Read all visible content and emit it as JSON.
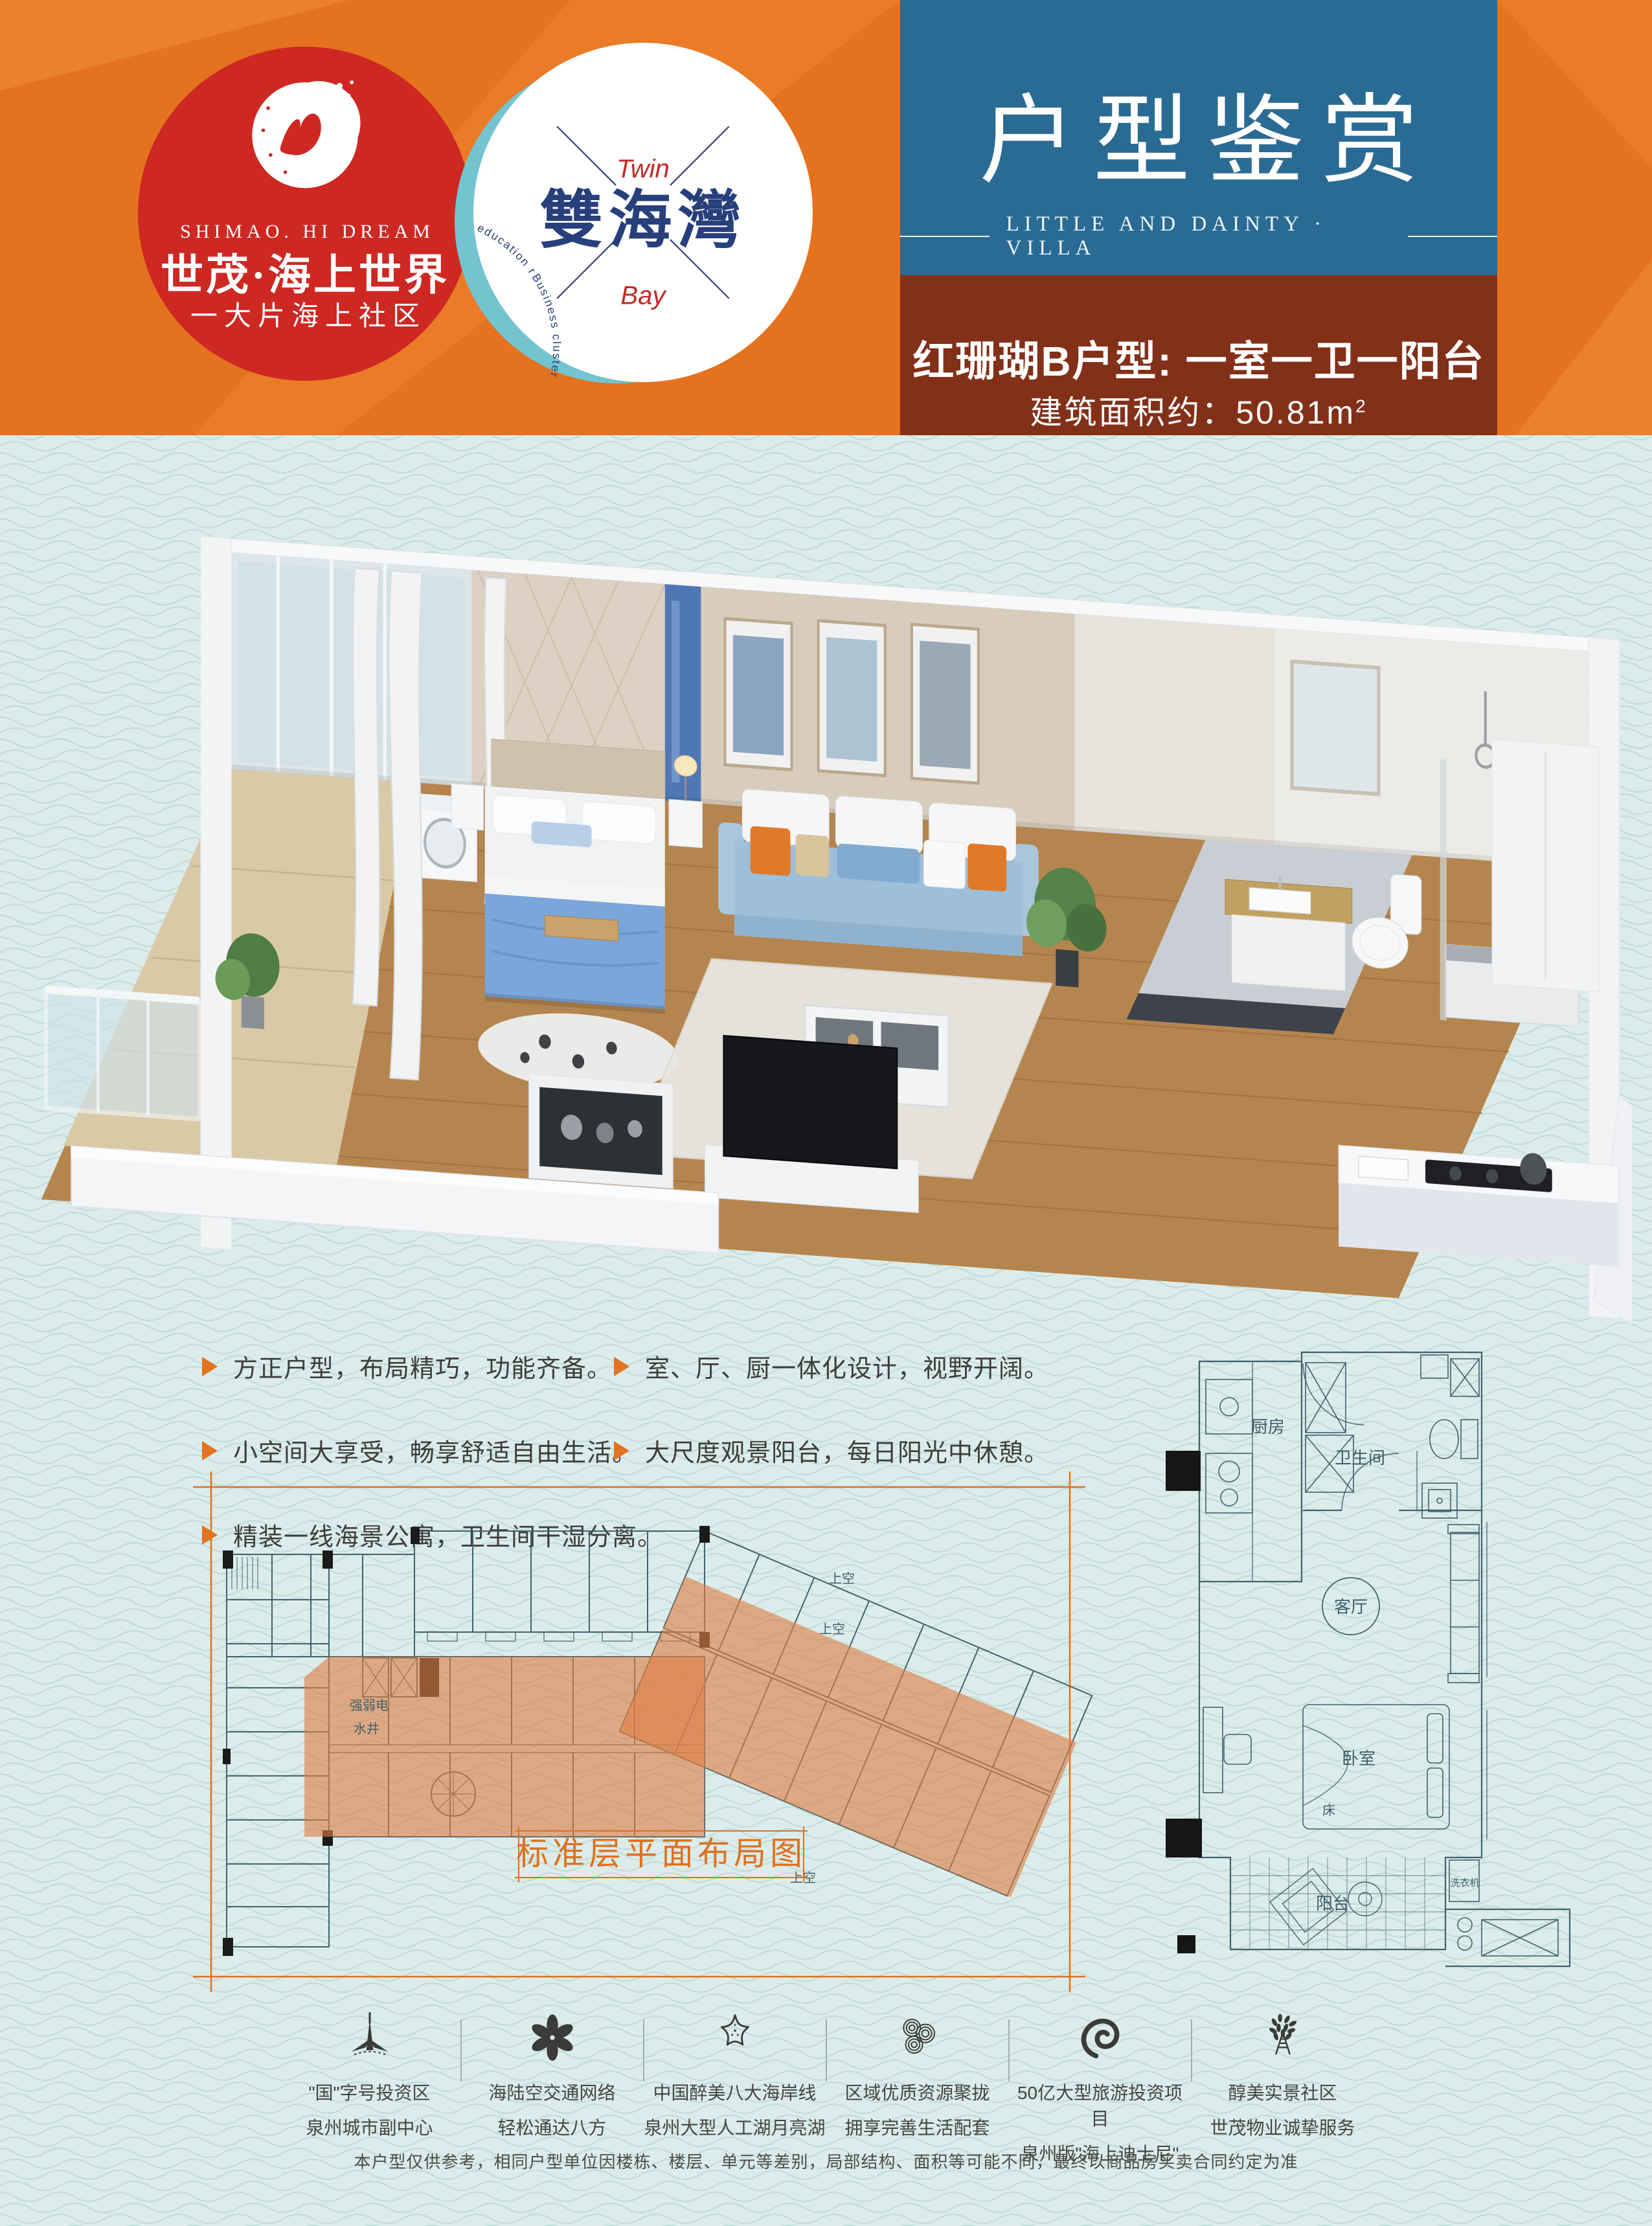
{
  "colors": {
    "header_orange": "#e4721e",
    "title_teal": "#2a6b94",
    "unit_brown": "#833019",
    "logo_red": "#ce2823",
    "body_mint": "#dcecea",
    "plan_line": "#42616e",
    "highlight_orange": "#dd7e43",
    "caption_orange": "#e0701f",
    "twinbay_navy": "#27407c"
  },
  "header": {
    "shimao": {
      "en": "SHIMAO. HI DREAM",
      "cn": "世茂·海上世界",
      "tagline": "一大片海上社区"
    },
    "twinbay": {
      "name": "雙海灣",
      "top": "Twin",
      "bottom": "Bay",
      "arc_text": "Business cluster | Hotel cluster | Quanzhou biggest artificial lake | Yacht Club | Mountain golf course | World-class education resources"
    },
    "title_box": {
      "title": "户型鉴赏",
      "subtitle": "LITTLE AND DAINTY · VILLA"
    },
    "unit_box": {
      "line1": "红珊瑚B户型: 一室一卫一阳台",
      "area_label": "建筑面积约：",
      "area_value": "50.81m",
      "area_sup": "2"
    }
  },
  "features": {
    "left": [
      {
        "text": "方正户型，布局精巧，功能齐备。"
      },
      {
        "text": "小空间大享受，畅享舒适自由生活。"
      },
      {
        "text": "精装一线海景公寓，卫生间干湿分离。"
      }
    ],
    "right": [
      {
        "text": "室、厅、厨一体化设计，视野开阔。"
      },
      {
        "text": "大尺度观景阳台，每日阳光中休憩。"
      }
    ]
  },
  "master_plan": {
    "caption": "标准层平面布局图",
    "labels": {
      "utility": "强弱电",
      "water": "水井",
      "void_a": "上空",
      "void_b": "上空",
      "void_c": "上空"
    }
  },
  "unit_plan": {
    "labels": {
      "kitchen": "厨房",
      "bathroom": "卫生间",
      "living": "客厅",
      "bedroom": "卧室",
      "bed": "床",
      "balcony": "阳台",
      "washer": "洗衣机"
    }
  },
  "footer": {
    "items": [
      {
        "icon": "tower-icon",
        "line1": "\"国\"字号投资区",
        "line2": "泉州城市副中心"
      },
      {
        "icon": "flower-icon",
        "line1": "海陆空交通网络",
        "line2": "轻松通达八方"
      },
      {
        "icon": "starfish-icon",
        "line1": "中国醉美八大海岸线",
        "line2": "泉州大型人工湖月亮湖"
      },
      {
        "icon": "coral-icon",
        "line1": "区域优质资源聚拢",
        "line2": "拥享完善生活配套"
      },
      {
        "icon": "nautilus-icon",
        "line1": "50亿大型旅游投资项目",
        "line2": "泉州版\"海上迪士尼\""
      },
      {
        "icon": "tree-icon",
        "line1": "醇美实景社区",
        "line2": "世茂物业诚挚服务"
      }
    ]
  },
  "disclaimer": "本户型仅供参考，相同户型单位因楼栋、楼层、单元等差别，局部结构、面积等可能不同，最终以商品房买卖合同约定为准"
}
